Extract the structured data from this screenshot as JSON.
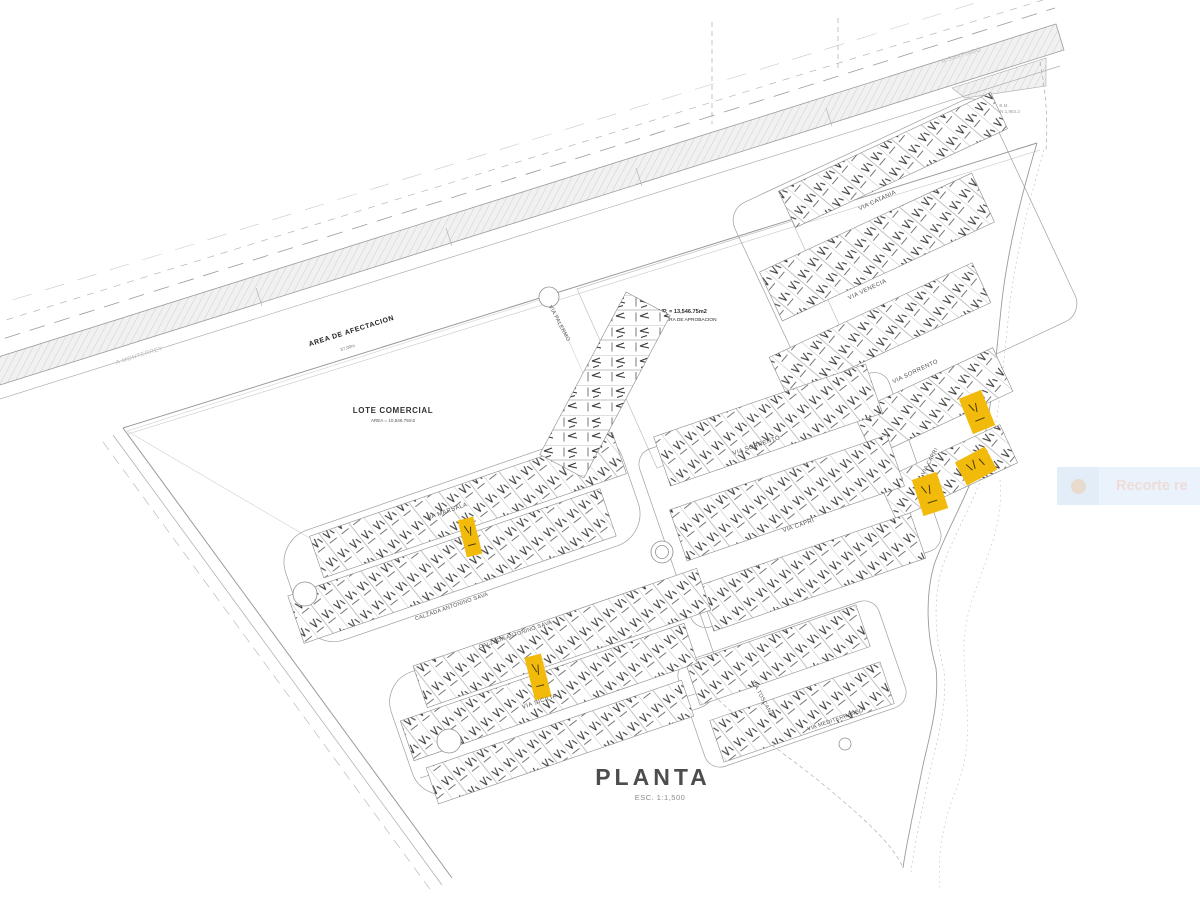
{
  "toast": {
    "text": "Recorte re"
  },
  "drawing": {
    "title": "PLANTA",
    "scale": "ESC. 1:1,500",
    "highway": {
      "label": "AREA DE AFECTACION",
      "width_note": "37.00m",
      "direction_right": "A SANTIAGO",
      "direction_left": "A MONTERREY"
    },
    "parcels": {
      "commercial_title": "LOTE COMERCIAL",
      "commercial_area": "AREA = 10,846.75m2",
      "excluded_sup": "SUP. = 13,546.75m2",
      "excluded_label": "AREA FUERA DE APROBACION"
    },
    "notes": {
      "benchmark1": "B.M.",
      "benchmark2": "N 1,983.3"
    },
    "streets": [
      "VIA CATANIA",
      "VIA VENECIA",
      "VIA SORRENTO",
      "VIA CAPRI",
      "VIA SORRENTO",
      "VIA CAPRI",
      "VIA PALERMO",
      "VIA MARSALA",
      "CALZADA ANTONINO SAVA",
      "CALZADA ANTONINO SAVA",
      "VIA SICILIA",
      "VIA TOSCANA",
      "VIA MEDITERRANEO"
    ],
    "highlighted_lots_count": 5,
    "colors": {
      "highlight": "#f2bb0c",
      "line": "#8c8c8c",
      "toast_bg": "#eaf3fb"
    }
  }
}
